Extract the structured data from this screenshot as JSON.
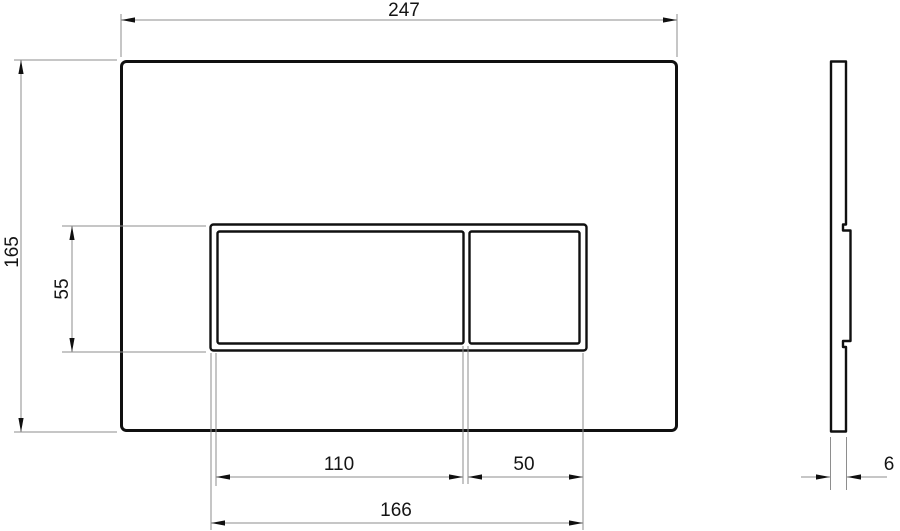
{
  "dims": {
    "plate_width": "247",
    "plate_height": "165",
    "button_panel_height": "55",
    "large_button_width": "110",
    "small_button_width": "50",
    "button_panel_width": "166",
    "plate_thickness": "6"
  },
  "colors": {
    "outline": "#101010",
    "dimension_line": "#8e8e8e",
    "arrow": "#101010",
    "text": "#141414",
    "background": "#ffffff"
  }
}
